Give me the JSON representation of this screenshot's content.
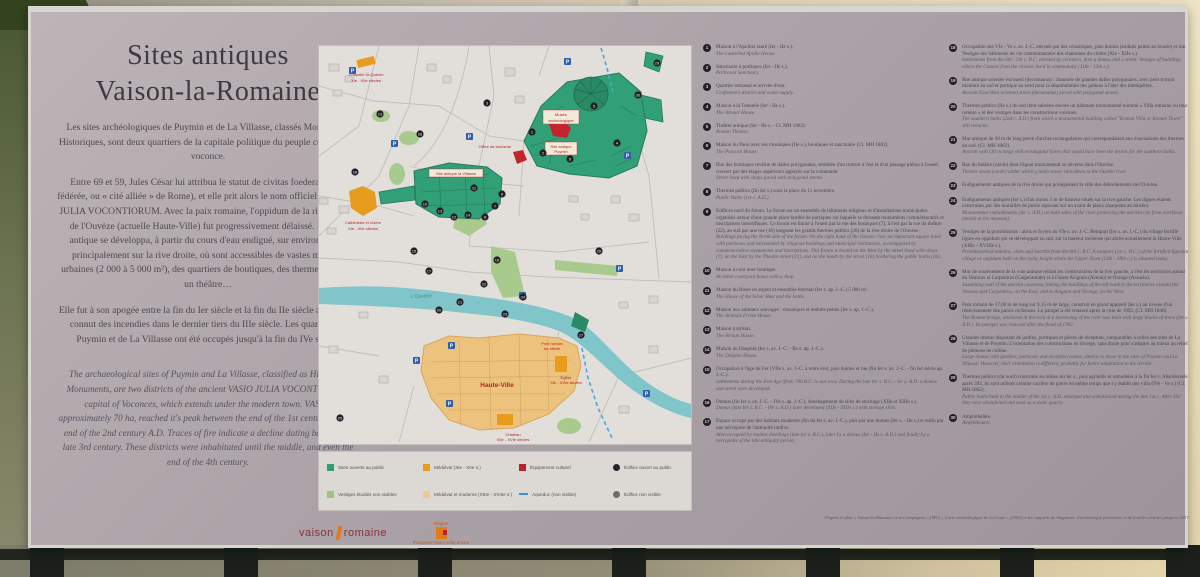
{
  "panel": {
    "title_line1": "Sites antiques",
    "title_line2": "Vaison-la-Romaine",
    "intro_fr_p1": "Les sites archéologiques de Puymin et de La Villasse, classés Monuments Historiques, sont deux quartiers de la capitale politique du peuple celto-ligure voconce.",
    "intro_fr_p2": "Entre 69 et 59, Jules César lui attribua le statut de civitas foederata (cité fédérée, ou « cité alliée » de Rome), et elle prit alors le nom officiel de VASIO JULIA VOCONTIORUM. Avec la paix romaine, l'oppidum de la rive gauche de l'Ouvèze (actuelle Haute-Ville) fut progressivement délaissé. La ville antique se développa, à partir du cours d'eau endigué, sur environ 70 ha, principalement sur la rive droite, où sont accessibles de vastes maisons urbaines (2 000 à 5 000 m²), des quartiers de boutiques, des thermes publics, un théâtre…",
    "intro_fr_p3": "Elle fut à son apogée entre la fin du Ier siècle et la fin du IIe siècle ap. J.-C. et connut des incendies dans le dernier tiers du IIIe siècle. Les quartiers de Puymin et de La Villasse ont été occupés jusqu'à la fin du IVe siècle.",
    "intro_en": "The archaeological sites of Puymin and La Villasse, classified as Historical Monuments, are two districts of the ancient VASIO JULIA VOCONTIORUM, capital of Voconces, which extends under the modern town. VASIO, approximately 70 ha, reached it's peak between the end of the 1st century and the end of the 2nd century A.D. Traces of fire indicate a decline dating back to the late 3rd century. These districts were inhabitated until the middle, and even the end of the 4th century."
  },
  "legend": {
    "items": [
      {
        "label": "Sites ouverts au public",
        "swatch": "background:#2e9e6f",
        "shape": "square"
      },
      {
        "label": "Vestiges étudiés non visibles",
        "swatch": "background:#9cc57e",
        "shape": "square"
      },
      {
        "label": "Médiéval (XIe - XIIe s.)",
        "swatch": "background:#e89c1e",
        "shape": "square"
      },
      {
        "label": "Médiéval et moderne (XIIIe - XVIIIe s.)",
        "swatch": "background:#f0c78c",
        "shape": "square"
      },
      {
        "label": "Équipement culturel",
        "swatch": "background:#b5232e",
        "shape": "square"
      },
      {
        "label": "Aqueduc (non visible)",
        "swatch": "",
        "shape": "dash"
      },
      {
        "label": "Édifice ouvert au public",
        "swatch": "background:#26232a",
        "shape": "round"
      },
      {
        "label": "Édifice non visible",
        "swatch": "background:#6e6a70",
        "shape": "round"
      }
    ]
  },
  "map": {
    "labels": {
      "chapelle_1": "Chapelle St-Quenin",
      "chapelle_2": "XIe - XIIe siècles",
      "cathedrale_1": "Cathédrale et cloître",
      "cathedrale_2": "XIe - XIIe siècles",
      "office": "Office de tourisme",
      "musee_1": "Musée",
      "musee_2": "archéologique",
      "puymin_1": "Site antique",
      "puymin_2": "Puymin",
      "villasse": "Site antique la Villasse",
      "hauteville": "Haute-Ville",
      "ouveze": "L'Ouvèze",
      "pont_1": "Pont romain",
      "pont_2": "Ier siècle",
      "eglise_1": "Église",
      "eglise_2": "XIe - XVIe siècles",
      "chateau_1": "Château",
      "chateau_2": "XIIe - XVIe siècles"
    },
    "parking_glyph": "P",
    "info_glyph": "i",
    "dots": [
      {
        "n": "1",
        "x": 213,
        "y": 86
      },
      {
        "n": "2",
        "x": 224,
        "y": 107
      },
      {
        "n": "3",
        "x": 168,
        "y": 57
      },
      {
        "n": "4",
        "x": 298,
        "y": 97
      },
      {
        "n": "5",
        "x": 275,
        "y": 60
      },
      {
        "n": "6",
        "x": 251,
        "y": 113
      },
      {
        "n": "7",
        "x": 176,
        "y": 160
      },
      {
        "n": "8",
        "x": 166,
        "y": 171
      },
      {
        "n": "9",
        "x": 183,
        "y": 148
      },
      {
        "n": "10",
        "x": 106,
        "y": 158
      },
      {
        "n": "11",
        "x": 155,
        "y": 142
      },
      {
        "n": "12",
        "x": 135,
        "y": 171
      },
      {
        "n": "13",
        "x": 121,
        "y": 165
      },
      {
        "n": "14",
        "x": 149,
        "y": 169
      },
      {
        "n": "15",
        "x": 95,
        "y": 205
      },
      {
        "n": "16",
        "x": 178,
        "y": 214
      },
      {
        "n": "17",
        "x": 110,
        "y": 225
      },
      {
        "n": "18",
        "x": 36,
        "y": 126
      },
      {
        "n": "19",
        "x": 61,
        "y": 68
      },
      {
        "n": "20",
        "x": 120,
        "y": 264
      },
      {
        "n": "21",
        "x": 141,
        "y": 256
      },
      {
        "n": "22",
        "x": 165,
        "y": 238
      },
      {
        "n": "23",
        "x": 186,
        "y": 268
      },
      {
        "n": "24",
        "x": 204,
        "y": 251
      },
      {
        "n": "25",
        "x": 21,
        "y": 372
      },
      {
        "n": "26",
        "x": 280,
        "y": 205
      },
      {
        "n": "27",
        "x": 262,
        "y": 289
      },
      {
        "n": "28",
        "x": 101,
        "y": 88
      },
      {
        "n": "29",
        "x": 338,
        "y": 17
      },
      {
        "n": "30",
        "x": 319,
        "y": 49
      }
    ],
    "parkings": [
      [
        30,
        21
      ],
      [
        72,
        94
      ],
      [
        147,
        87
      ],
      [
        305,
        106
      ],
      [
        200,
        246
      ],
      [
        297,
        219
      ],
      [
        129,
        296
      ],
      [
        94,
        311
      ],
      [
        127,
        354
      ],
      [
        324,
        344
      ],
      [
        245,
        12
      ]
    ]
  },
  "columns": {
    "col1": [
      {
        "n": "1",
        "fr": "Maison à l'Apollon lauré (Ier - IIe s.).",
        "en": "The Laurelled Apollo House."
      },
      {
        "n": "2",
        "fr": "Sanctuaire à portiques (Ier - IIe s.).",
        "en": "Porticoed Sanctuary."
      },
      {
        "n": "3",
        "fr": "Quartier artisanal et arrivée d'eau.",
        "en": "Craftsmen's district and water supply."
      },
      {
        "n": "4",
        "fr": "Maison à la Tonnelle (Ier - IIe s.).",
        "en": "The Arbour House."
      },
      {
        "n": "5",
        "fr": "Théâtre antique (Ier - IIe s. - Cl. MH 1862).",
        "en": "Roman Theatre."
      },
      {
        "n": "6",
        "fr": "Maison du Paon avec ses mosaïques (IIe s.), boutiques et sanctuaire (Cl. MH 1862).",
        "en": "The Peacock House."
      },
      {
        "n": "7",
        "fr": "Rue des boutiques revêtue de dalles polygonales, semblée d'un trottoir à l'est et d'un passage piéton à l'ouest, couvert par des étages supérieurs appuyés sur la colonnade.",
        "en": "Street lined with shops paved with polygonal stones."
      },
      {
        "n": "8",
        "fr": "Thermes publics (fin Ier s.) sous la place du 11 novembre.",
        "en": "Public Baths (1st c. A.D.)."
      },
      {
        "n": "9",
        "fr": "Édifices nord du forum. Le forum est un ensemble de bâtiments religieux et d'installations municipales organisés autour d'une grande place bordée de portiques sur laquelle se dressent monuments commémoratifs et inscriptions honorifiques. Ce forum est limité à l'ouest par la rue des boutiques (7), à l'est par la rue du théâtre (22), au sud par une rue (16) longeant les grands thermes publics (26) de la rive droite de l'Ouvèze.",
        "en": "Buildings facing the North side of the forum. On the right bank of the Ouvèze river an important square lined with porticoes and surrounded by religious buildings and municipal institutions, accompanied by commemorative monuments and inscriptions. This forum is bound on the West by the street lined with shops (7), on the East by the Theatre street (22), and on the South by the street (16) bordering the public baths (26)."
      },
      {
        "n": "10",
        "fr": "Maison à cour avec boutique.",
        "en": "An inner courtyard house with a shop."
      },
      {
        "n": "11",
        "fr": "Maison du Buste en argent et ensemble thermal (Ier s. ap. J.-C.) 5 000 m².",
        "en": "The House of the Silver Bust and the baths."
      },
      {
        "n": "12",
        "fr": "Maison aux animaux sauvages : mosaïques et enduits peints (Ier s. ap. J.-C.).",
        "en": "The Animals Frieze House."
      },
      {
        "n": "13",
        "fr": "Maison à atrium.",
        "en": "The Atrium House."
      },
      {
        "n": "14",
        "fr": "Maison au Dauphin (Ier s. av. J.-C. - IIe s. ap. J.-C.).",
        "en": "The Dolphin House."
      },
      {
        "n": "15",
        "fr": "Occupation à l'âge du Fer (VIIe s. av. J.-C. à notre ère), puis domus et rue (fin Ier s. av. J.-C. - fin Ier siècle ap. J.-C.).",
        "en": "Settlements during the Iron Age (from 700 B.C. to our era). During the late Ier s. B.C. - Ier s. A.D. a domus and street were developed."
      },
      {
        "n": "16",
        "fr": "Domus (fin Ier s. av. J.-C. - IVe s. ap. J.-C.). Aménagement de silos de stockage (XIIe et XIIIe s.).",
        "en": "Domus (late Ier s. B.C. - IVe s. A.D.) later developed (XIIe - XIIIe s.) with storage silos."
      },
      {
        "n": "17",
        "fr": "Espace occupé par des habitats modestes (fin du Ier s. av. J.-C.), puis par une domus (Ier s. - IIe s.) et enfin par une nécropole de l'antiquité tardive.",
        "en": "Area occupied by modest dwellings (late Ier s. B.C.), later by a domus (Ier - IIe s. A.D.) and finally by a necropolis of the late antiquity period."
      }
    ],
    "col2": [
      {
        "n": "18",
        "fr": "Occupation des VIe - Ve s. av. J.-C. attestée par des céramiques, puis domus (enduits peints au musée) et rue. Vestiges des bâtiments de vie communautaire des chanoines du cloître (XIe - XIIe s.).",
        "en": "Settlements from the 6th - 5th c. B.C. attested by ceramics, then a domus and a street. Vestiges of buildings where the Canons from the cloister lived in commonalty (11th - 12th c.)."
      },
      {
        "n": "19",
        "fr": "Rue antique orientée est/ouest (decumanus) : chaussée de grandes dalles polygonales, avec petit trottoir mouluré au sud et portique au nord pour la déambulation des piétons à l'abri des intempéries.",
        "en": "Ancient East-West oriented street (decumanus) paved with polygonal stones."
      },
      {
        "n": "20",
        "fr": "Thermes publics (IIe s.) du sud dont subsiste encore un bâtiment monumental nommé « Villa romaine ou mur romain » et des vestiges dans les constructions voisines.",
        "en": "The southern baths (2nd c. A.D.) from which a monumental building called \"Roman Villa or Roman Tower\" still remains."
      },
      {
        "n": "21",
        "fr": "Mur antique de 30 m de long percé d'arches rectangulaires qui correspondaient aux évacuations des thermes du sud. (Cl. MH 1862).",
        "en": "Ancient wall (30 m long) with rectangular holes that would have been the drains for the southern baths."
      },
      {
        "n": "22",
        "fr": "Rue du théâtre (cardo) dont l'égout monumental se déverse dans l'Ouvèze.",
        "en": "Theatre street (cardo) under which a main sewer runs down to the Ouvèze river."
      },
      {
        "n": "23",
        "fr": "Endiguements antiques de la rive droite qui protégeaient la ville des débordements de l'Ouvèze.",
        "en": ""
      },
      {
        "n": "24",
        "fr": "Endiguements antiques (Ier s.) d'au moins 5 m de hauteur situés sur la rive gauche. Les digues étaient construites par des murailles de pierre reposant sur un avant de pieux (maquette au musée).",
        "en": "Monumental embankments (Ier s. A.D.) on both sides of the river protecting the ancient city from overflows (model at the museum)."
      },
      {
        "n": "25",
        "fr": "Vestiges de la protohistoire : abris et foyers du VIe s. av. J.-C. Rempart (Ier s. av. J.-C.) du village fortifié ligure en oppidum qui se développait au sud, sur la hauteur rocheuse qui abrite actuellement la Haute-Ville (XIIIe - XVIIIe s.).",
        "en": "Protohistorical remains, slabs and hearths from the 6th c. B.C. A rampart (1st c. B.C.) of the fortified ligurian village or oppidum built on the rocky height where the Upper Town (13th - 18th c.) is situated today."
      },
      {
        "n": "26",
        "fr": "Mur de soutènement de la voie antique reliant les constructions de la rive gauche, à l'est les territoires autour du Ventoux et Carpentras (Carpentorate) et à l'ouest Avignon (Avenio) et Orange (Arausio).",
        "en": "Sustaining wall of the ancient causeway linking the buildings of the left bank to the territories around the Ventoux and Carpentras, on the East, and to Avignon and Orange, on the West."
      },
      {
        "n": "27",
        "fr": "Pont romain de 17,00 m de long sur 9,15 m de large, construit en grand appareil (Ier s.) au niveau d'un rétrécissement des parois rocheuses. Le parapet a été restauré après la crue de 1992. (Cl. MH 1840).",
        "en": "The Roman bridge, anchored in the rock at a narrowing of the river was built with large blocks of stone (Ier s. A.D.). Its parapet was restored after the flood of 1992."
      },
      {
        "n": "28",
        "fr": "Grandes domus disposant de jardins, portiques et pièces de réception, comparables à celles des sites de La Villasse et de Puymin. L'orientation des constructions en diverge, sans doute pour s'adapter au mieux au relief de piémont de colline.",
        "en": "Large domus with gardens, porticoes and reception rooms, similar to those in the sites of Puymin and La Villasse. However, their orientation is different, probably for better adaptation to the terrain."
      },
      {
        "n": "29",
        "fr": "Thermes publics (du nord) construits au milieu du Ier s., puis agrandis et remodelés à la fin Ier s. Abandonnés après 392, ils sont utilisés comme carrière de pierre en même temps que s'y établit une villa (IVe - Ve s.) (Cl. MH 1862).",
        "en": "Public baths built in the middle of the 1st c. A.D. enlarged and embellished during the late 1st c. After 392 they were abandoned and used as a stone quarry."
      },
      {
        "n": "30",
        "fr": "Amphithéâtre.",
        "en": "Amphitheatre."
      }
    ]
  },
  "footnote": "D'après le plan « Vaison-la-Romaine et ses campagnes » (MC) « Carte archéologique de la Gaule » (2003) et les rapports de diagnostic d'archéologie préventive et de fouilles réalisés jusqu'en 2017.",
  "logos": {
    "vaison_left": "vaison",
    "vaison_right": "romaine",
    "region_top": "Région",
    "region_bottom": "Provence-Alpes Côte d'Azur"
  },
  "colors": {
    "site_open": "#2e9e6f",
    "site_studied": "#9cc57e",
    "medieval": "#e89c1e",
    "medieval_modern": "#f0c78c",
    "cultural": "#b5232e",
    "aqueduct": "#3b8fd0",
    "river": "#7fc5ca",
    "label_red": "#b5232e"
  }
}
